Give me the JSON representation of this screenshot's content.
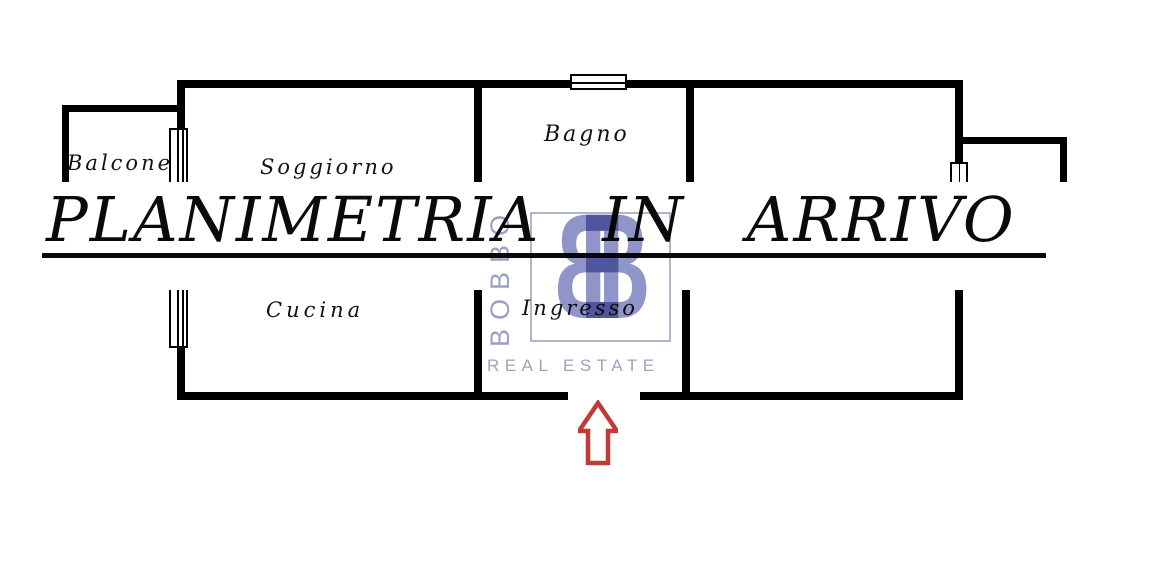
{
  "notice": {
    "title": "PLANIMETRIA IN ARRIVO"
  },
  "floorplan": {
    "rooms": [
      {
        "label": "Balcone"
      },
      {
        "label": "Soggiorno"
      },
      {
        "label": "Bagno"
      },
      {
        "label": "Cucina"
      },
      {
        "label": "Ingresso"
      }
    ]
  },
  "watermark": {
    "monogram_left": "B",
    "monogram_right": "B",
    "brand_vertical": "BOBBO",
    "tagline": "REAL ESTATE"
  },
  "icons": {
    "entrance_arrow": "up-arrow-icon"
  },
  "colors": {
    "wall": "#000000",
    "notice_text": "#0a0a0a",
    "watermark_blue": "#8f94c9",
    "watermark_gray": "#9aa0c4",
    "arrow_red": "#c23a34"
  }
}
